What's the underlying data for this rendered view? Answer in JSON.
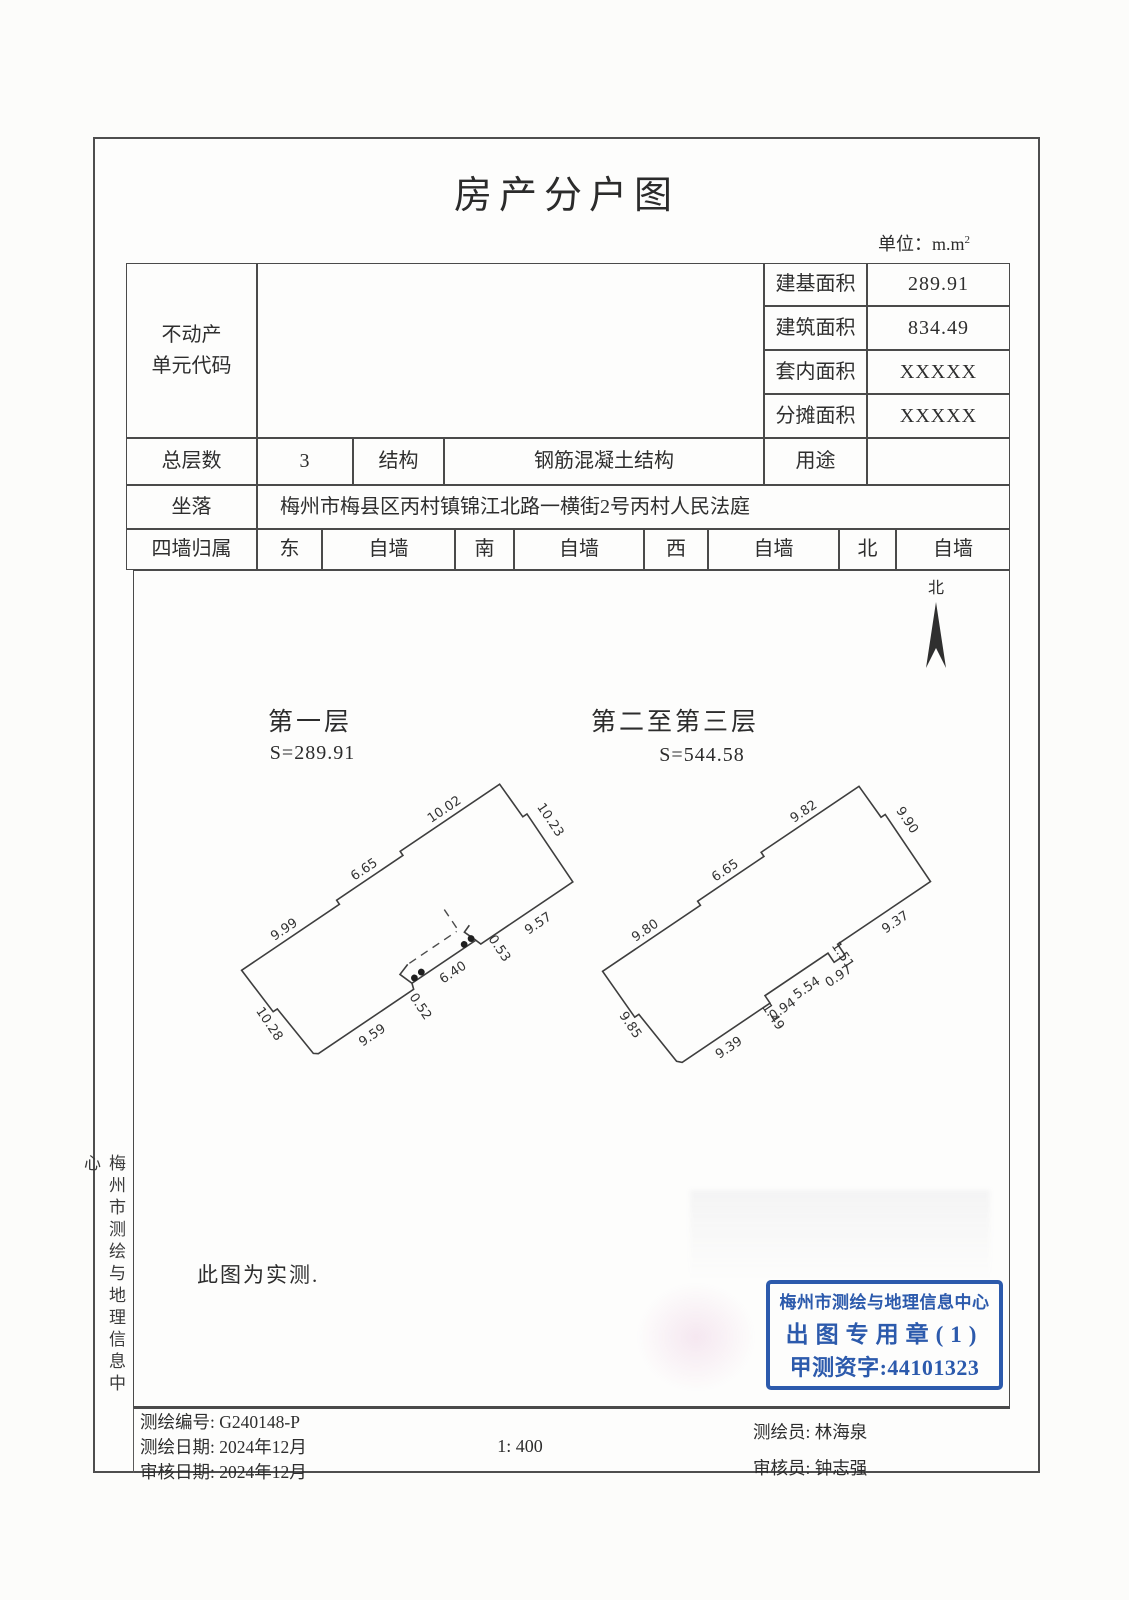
{
  "page": {
    "title": "房产分户图",
    "unit_prefix": "单位：m.m",
    "unit_sup": "2"
  },
  "table": {
    "unit_code_line1": "不动产",
    "unit_code_line2": "单元代码",
    "area_rows": [
      {
        "label": "建基面积",
        "value": "289.91"
      },
      {
        "label": "建筑面积",
        "value": "834.49"
      },
      {
        "label": "套内面积",
        "value": "XXXXX"
      },
      {
        "label": "分摊面积",
        "value": "XXXXX"
      }
    ],
    "floors_label": "总层数",
    "floors_value": "3",
    "structure_label": "结构",
    "structure_value": "钢筋混凝土结构",
    "usage_label": "用途",
    "usage_value": "",
    "location_label": "坐落",
    "location_value": "梅州市梅县区丙村镇锦江北路一横街2号丙村人民法庭",
    "walls_label": "四墙归属",
    "walls": [
      {
        "dir": "东",
        "own": "自墙"
      },
      {
        "dir": "南",
        "own": "自墙"
      },
      {
        "dir": "西",
        "own": "自墙"
      },
      {
        "dir": "北",
        "own": "自墙"
      }
    ]
  },
  "compass": {
    "label": "北"
  },
  "plans": [
    {
      "name": "第一层",
      "area": "S=289.91",
      "dims": [
        "9.99",
        "6.65",
        "10.02",
        "10.23",
        "9.57",
        "0.52",
        "6.40",
        "0.53",
        "9.59",
        "10.28"
      ]
    },
    {
      "name": "第二至第三层",
      "area": "S=544.58",
      "dims": [
        "9.80",
        "6.65",
        "9.82",
        "9.90",
        "9.37",
        "1.51",
        "0.97",
        "5.54",
        "0.94",
        "1.49",
        "9.39",
        "9.85"
      ]
    }
  ],
  "side_text": "梅州市测绘与地理信息中心",
  "note": "此图为实测.",
  "stamp": {
    "line1": "梅州市测绘与地理信息中心",
    "line2": "出图专用章(1)",
    "line3": "甲测资字:44101323",
    "color": "#1d4ea6"
  },
  "footer": {
    "no": "测绘编号: G240148-P",
    "survey_date": "测绘日期: 2024年12月",
    "review_date": "审核日期: 2024年12月",
    "scale": "1: 400",
    "surveyor": "测绘员: 林海泉",
    "reviewer": "审核员: 钟志强"
  }
}
